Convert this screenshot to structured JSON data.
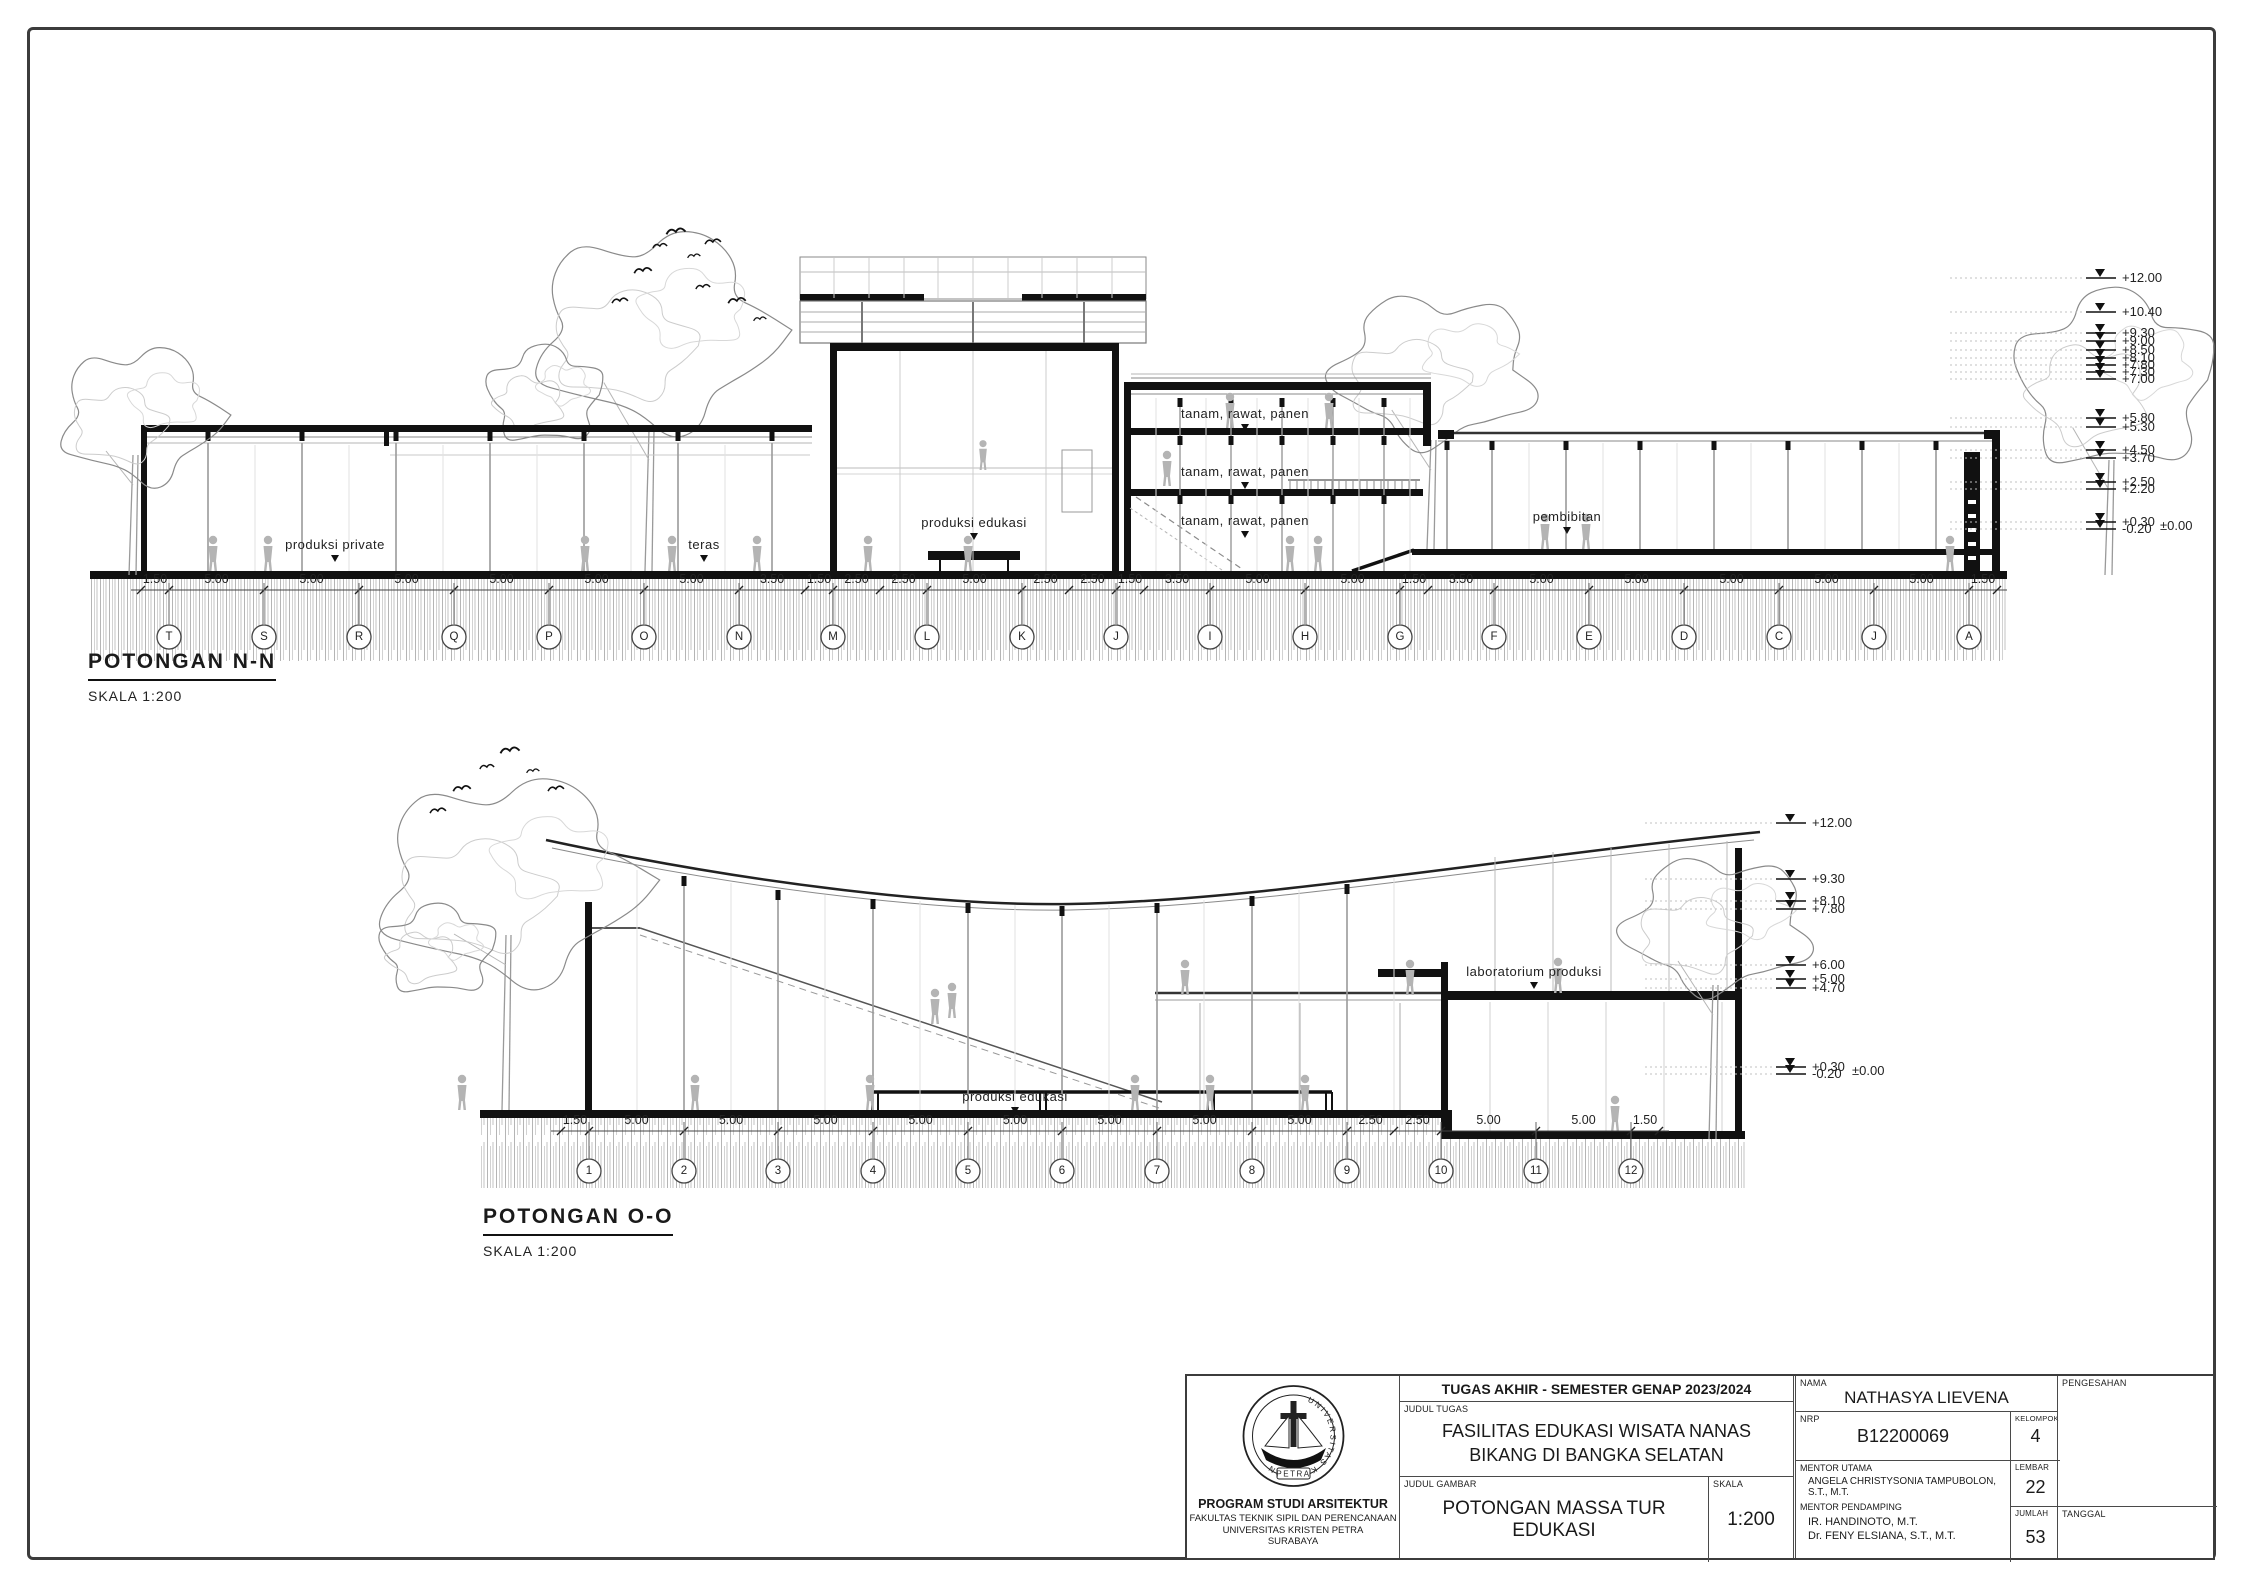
{
  "sheet": {
    "width": 2245,
    "height": 1587
  },
  "sections": [
    {
      "title": "POTONGAN N-N",
      "scale_label": "SKALA 1:200",
      "dimensions": [
        "1.50",
        "5.00",
        "5.00",
        "5.00",
        "5.00",
        "5.00",
        "5.00",
        "3.50",
        "1.50",
        "2.50",
        "2.50",
        "5.00",
        "2.50",
        "2.50",
        "1.50",
        "3.50",
        "5.00",
        "5.00",
        "1.50",
        "3.50",
        "5.00",
        "5.00",
        "5.00",
        "5.00",
        "5.00",
        "1.50"
      ],
      "grid_labels": [
        "T",
        "S",
        "R",
        "Q",
        "P",
        "O",
        "N",
        "M",
        "L",
        "K",
        "J",
        "I",
        "H",
        "G",
        "F",
        "E",
        "D",
        "C",
        "J",
        "A"
      ],
      "elevations": [
        "+12.00",
        "+10.40",
        "+9.30",
        "+9.00",
        "+8.50",
        "+8.10",
        "+7.80",
        "+7.30",
        "+7.00",
        "+5.80",
        "+5.30",
        "+4.50",
        "+3.70",
        "+2.50",
        "+2.20",
        "+0.30",
        "-0.20",
        "±0.00"
      ],
      "room_labels": [
        "produksi private",
        "teras",
        "produksi edukasi",
        "tanam, rawat, panen",
        "tanam, rawat, panen",
        "tanam, rawat, panen",
        "pembibitan"
      ]
    },
    {
      "title": "POTONGAN O-O",
      "scale_label": "SKALA 1:200",
      "dimensions": [
        "1.50",
        "5.00",
        "5.00",
        "5.00",
        "5.00",
        "5.00",
        "5.00",
        "5.00",
        "5.00",
        "2.50",
        "2.50",
        "5.00",
        "5.00",
        "1.50"
      ],
      "grid_labels": [
        "1",
        "2",
        "3",
        "4",
        "5",
        "6",
        "7",
        "8",
        "9",
        "10",
        "11",
        "12"
      ],
      "elevations": [
        "+12.00",
        "+9.30",
        "+8.10",
        "+7.80",
        "+6.00",
        "+5.00",
        "+4.70",
        "+0.30",
        "-0.20",
        "±0.00"
      ],
      "room_labels": [
        "produksi edukasi",
        "laboratorium produksi"
      ]
    }
  ],
  "title_block": {
    "header": "TUGAS AKHIR - SEMESTER GENAP 2023/2024",
    "labels": {
      "judul_tugas": "JUDUL TUGAS",
      "judul_gambar": "JUDUL GAMBAR",
      "skala": "SKALA",
      "nama": "NAMA",
      "nrp": "NRP",
      "kelompok": "KELOMPOK",
      "mentor_utama": "MENTOR UTAMA",
      "mentor_pendamping": "MENTOR PENDAMPING",
      "lembar": "LEMBAR",
      "jumlah": "JUMLAH",
      "pengesahan": "PENGESAHAN",
      "tanggal": "TANGGAL"
    },
    "judul_tugas_line1": "FASILITAS EDUKASI WISATA NANAS",
    "judul_tugas_line2": "BIKANG DI BANGKA SELATAN",
    "judul_gambar": "POTONGAN MASSA TUR EDUKASI",
    "skala": "1:200",
    "nama": "NATHASYA LIEVENA",
    "nrp": "B12200069",
    "kelompok": "4",
    "mentor_utama": "ANGELA CHRISTYSONIA TAMPUBOLON, S.T., M.T.",
    "mentor_pendamping_1": "IR. HANDINOTO, M.T.",
    "mentor_pendamping_2": "Dr. FENY ELSIANA, S.T., M.T.",
    "lembar": "22",
    "jumlah": "53",
    "institution": {
      "program": "PROGRAM STUDI ARSITEKTUR",
      "faculty": "FAKULTAS TEKNIK SIPIL DAN PERENCANAAN",
      "university": "UNIVERSITAS KRISTEN PETRA",
      "city": "SURABAYA"
    },
    "logo": {
      "ring_text": "UNIVERSITAS KRISTEN",
      "banner_text": "PETRA"
    }
  }
}
